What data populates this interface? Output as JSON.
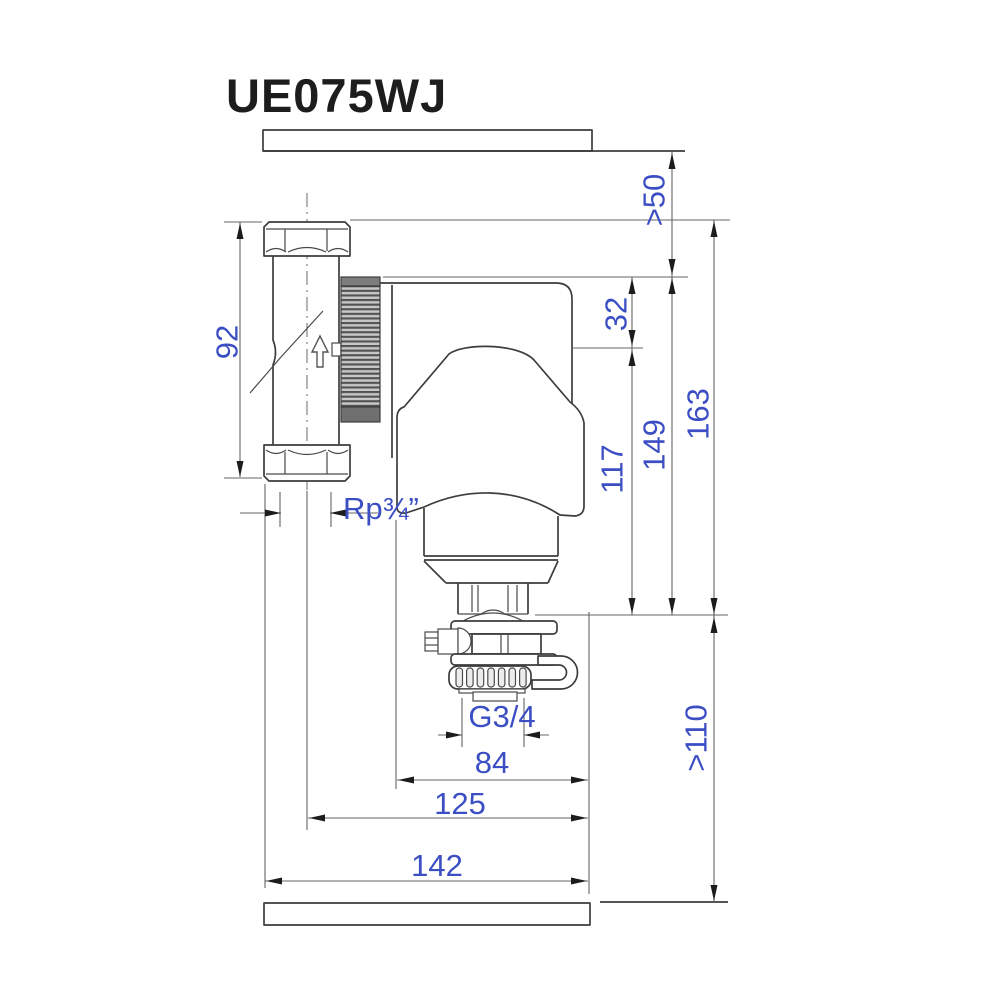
{
  "title": "UE075WJ",
  "dimensions": {
    "clearance_above": ">50",
    "union_length": "92",
    "cover_offset": "32",
    "body_height": "117",
    "mid_height": "149",
    "total_height": "163",
    "pipe_thread": "Rp¾”",
    "drain_thread": "G3/4",
    "body_width": "84",
    "pipe_center_width": "125",
    "overall_width": "142",
    "clearance_below": ">110"
  },
  "colors": {
    "dimension_text": "#3b4ec4",
    "object_line": "#3d3d3d",
    "background": "#ffffff"
  },
  "symbols": {
    "flow_direction": "up-arrow",
    "walls": "hatched-section"
  }
}
